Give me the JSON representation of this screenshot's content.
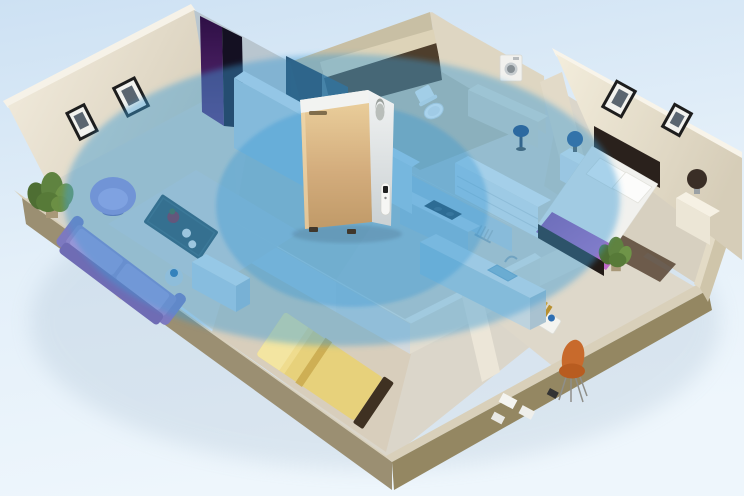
{
  "scene": {
    "description": "Isometric 3D cutaway rendering of an apartment; a champagne-gold air purifier stands in the central hallway and two translucent blue ellipses radiating from it show whole-home purification coverage across the living room, hallway, bathroom, kitchen, master bedroom, small bedroom and study.",
    "background": {
      "top": "#cde1f3",
      "middle": "#e3eff9",
      "bottom": "#eef6fc"
    },
    "coverage": {
      "outer": {
        "cx": 342,
        "cy": 200,
        "rx": 278,
        "ry": 146,
        "color": "#3e9bd7",
        "opacity": 0.44
      },
      "inner": {
        "cx": 352,
        "cy": 206,
        "rx": 136,
        "ry": 101,
        "color": "#2e92d2",
        "opacity": 0.32
      }
    },
    "device": {
      "label": "air-purifier",
      "front_color": "#d3ac7c",
      "side_color": "#edf0f0",
      "lid_color": "#f2f3f1",
      "brand_mark_legible": false,
      "features": [
        "top-handle-cutout",
        "small-brand-mark",
        "side-control-strip",
        "feet"
      ]
    },
    "rooms": [
      {
        "name": "living-room",
        "furniture": [
          "purple-round-chair",
          "purple-sofa",
          "teal-coffee-table",
          "flower-pot",
          "white-plates",
          "rug",
          "tv-cabinet",
          "side-table-vase",
          "corner-plant",
          "wall-frames"
        ]
      },
      {
        "name": "hallway",
        "furniture": [
          "purple-wardrobe",
          "dark-doorway",
          "tall-blue-cabinet",
          "half-wall"
        ]
      },
      {
        "name": "bathroom",
        "furniture": [
          "toilet",
          "washing-machine",
          "wall-shelf",
          "dark-niche",
          "vanity-counter"
        ]
      },
      {
        "name": "kitchen",
        "furniture": [
          "back-counter",
          "stove",
          "dish-rack",
          "island-counter",
          "sink",
          "faucet",
          "tall-cabinet"
        ]
      },
      {
        "name": "master-bedroom",
        "furniture": [
          "double-bed",
          "dark-headboard",
          "white-pillows",
          "purple-bed-runner",
          "dark-foot-rug",
          "nightstand-left",
          "blue-lamp",
          "nightstand-right",
          "dark-lamp",
          "dresser",
          "desk-lamp",
          "wall-frames",
          "plant"
        ]
      },
      {
        "name": "small-bedroom",
        "furniture": [
          "yellow-single-bed"
        ]
      },
      {
        "name": "study",
        "furniture": [
          "orange-chair",
          "floor-papers",
          "drink-tray",
          "bottles"
        ]
      }
    ],
    "palette": {
      "wall_cream": "#ece5d4",
      "wall_shadow": "#cfc6b2",
      "wall_khaki": "#c8bfa4",
      "niche_brown": "#4e3e2c",
      "plinth_tan": "#9b8f72",
      "plinth_rim": "#d9d0ba",
      "floor_gray": "#dbd6ca",
      "floor_wood": "#d8cebc",
      "partition_light": "#c3d4de",
      "gold": "#d3ac7c",
      "accent_purple_chair": "#9a8ed6",
      "sofa_purple": "#8a86ca",
      "wardrobe_purple": "#4a2068",
      "bed_runner": "#a64fb0",
      "yellow_bed": "#e7d17b",
      "orange_chair": "#c2642a",
      "teal_table": "#2f4e5a",
      "coverage_blue": "#3e9bd7"
    }
  }
}
